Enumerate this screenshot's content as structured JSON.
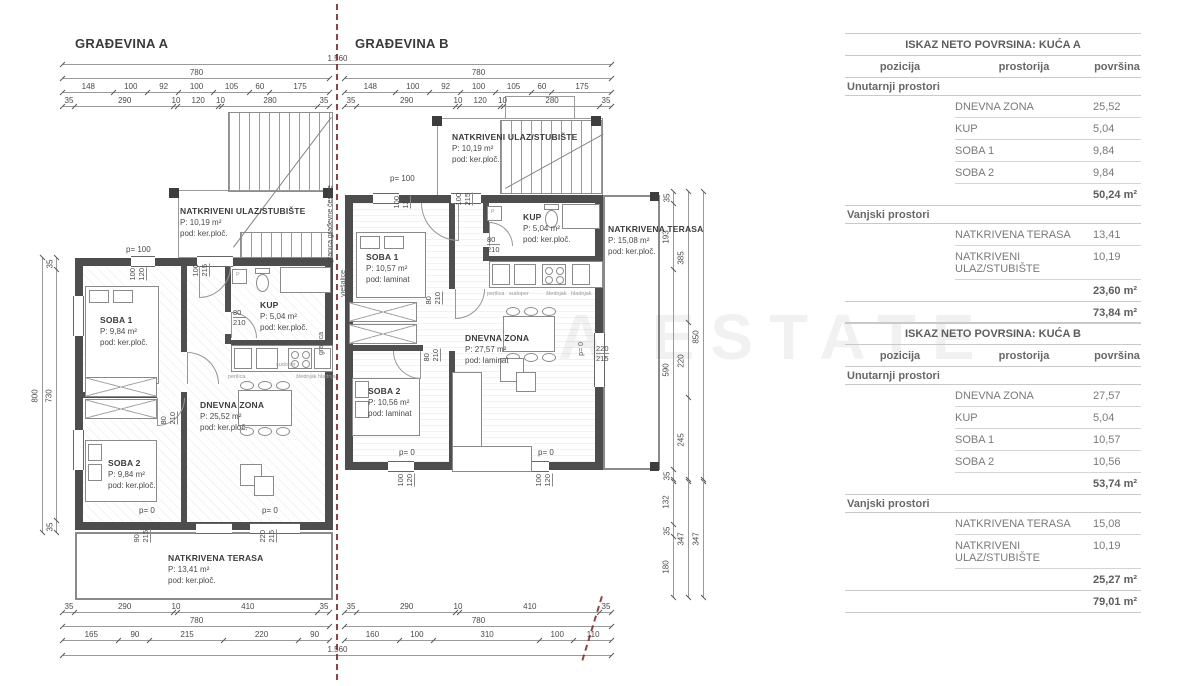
{
  "drawing": {
    "watermark": "A ESTATE",
    "boundary_label": "granica građevne čestice",
    "buildings": [
      {
        "title": "GRAĐEVINA A",
        "rooms": {
          "ulaz": {
            "name": "NATKRIVENI ULAZ/STUBIŠTE",
            "area": "P: 10,19 m²",
            "floor": "pod: ker.ploč."
          },
          "soba1": {
            "name": "SOBA 1",
            "area": "P: 9,84 m²",
            "floor": "pod: ker.ploč."
          },
          "kup": {
            "name": "KUP",
            "area": "P: 5,04 m²",
            "floor": "pod: ker.ploč."
          },
          "dnevna": {
            "name": "DNEVNA ZONA",
            "area": "P: 25,52 m²",
            "floor": "pod: ker.ploč."
          },
          "soba2": {
            "name": "SOBA 2",
            "area": "P: 9,84 m²",
            "floor": "pod: ker.ploč."
          },
          "terasa": {
            "name": "NATKRIVENA TERASA",
            "area": "P: 13,41 m²",
            "floor": "pod: ker.ploč."
          }
        }
      },
      {
        "title": "GRAĐEVINA B",
        "rooms": {
          "ulaz": {
            "name": "NATKRIVENI ULAZ/STUBIŠTE",
            "area": "P: 10,19 m²",
            "floor": "pod: ker.ploč."
          },
          "soba1": {
            "name": "SOBA 1",
            "area": "P: 10,57 m²",
            "floor": "pod: laminat"
          },
          "kup": {
            "name": "KUP",
            "area": "P: 5,04 m²",
            "floor": "pod: ker.ploč."
          },
          "dnevna": {
            "name": "DNEVNA ZONA",
            "area": "P: 27,57 m²",
            "floor": "pod: laminat"
          },
          "soba2": {
            "name": "SOBA 2",
            "area": "P: 10,56 m²",
            "floor": "pod: laminat"
          },
          "terasa": {
            "name": "NATKRIVENA TERASA",
            "area": "P: 15,08 m²",
            "floor": "pod: ker.ploč."
          }
        }
      }
    ],
    "chains": {
      "total_top": [
        "1.560"
      ],
      "w780": [
        "780"
      ],
      "a_top_seg": [
        "148",
        "100",
        "92",
        "100",
        "105",
        "60",
        "175"
      ],
      "a_top_wall": [
        "35",
        "290",
        "10",
        "120",
        "10",
        "280",
        "35"
      ],
      "a_bot_wall": [
        "35",
        "290",
        "10",
        "410",
        "35"
      ],
      "a_bot_seg": [
        "165",
        "90",
        "215",
        "220",
        "90"
      ],
      "b_bot_seg": [
        "160",
        "100",
        "310",
        "100",
        "110"
      ],
      "total_bot": [
        "1.560"
      ],
      "left_inner": [
        "35",
        "730",
        "35"
      ],
      "left_outer": [
        "800"
      ],
      "right_inner_top": [
        "35",
        "193",
        "590",
        "35"
      ],
      "right_inner_bot": [
        "132",
        "35",
        "180"
      ],
      "right_mid_top": [
        "385",
        "220",
        "245"
      ],
      "right_mid_bot": [
        "347"
      ],
      "right_out_top": [
        "850"
      ],
      "right_out_bot": [
        "347"
      ]
    },
    "annotations": [
      {
        "k": "h",
        "x": 126,
        "y": 245,
        "t": "p= 100"
      },
      {
        "k": "vp",
        "x": 128,
        "y": 268,
        "a": "100",
        "b": "120"
      },
      {
        "k": "vp",
        "x": 191,
        "y": 264,
        "a": "100",
        "b": "215"
      },
      {
        "k": "hp",
        "x": 233,
        "y": 308,
        "a": "80",
        "b": "210"
      },
      {
        "k": "vp",
        "x": 159,
        "y": 412,
        "a": "80",
        "b": "210"
      },
      {
        "k": "h",
        "x": 139,
        "y": 506,
        "t": "p= 0"
      },
      {
        "k": "h",
        "x": 262,
        "y": 506,
        "t": "p= 0"
      },
      {
        "k": "vp",
        "x": 132,
        "y": 530,
        "a": "90",
        "b": "215"
      },
      {
        "k": "vp",
        "x": 258,
        "y": 530,
        "a": "220",
        "b": "215"
      },
      {
        "k": "h",
        "x": 390,
        "y": 174,
        "t": "p= 100"
      },
      {
        "k": "vp",
        "x": 392,
        "y": 196,
        "a": "100",
        "b": "120"
      },
      {
        "k": "vp",
        "x": 454,
        "y": 193,
        "a": "100",
        "b": "215"
      },
      {
        "k": "hp",
        "x": 487,
        "y": 235,
        "a": "80",
        "b": "210"
      },
      {
        "k": "vp",
        "x": 424,
        "y": 292,
        "a": "80",
        "b": "210"
      },
      {
        "k": "vp",
        "x": 422,
        "y": 349,
        "a": "80",
        "b": "210"
      },
      {
        "k": "h",
        "x": 399,
        "y": 448,
        "t": "p= 0"
      },
      {
        "k": "h",
        "x": 538,
        "y": 448,
        "t": "p= 0"
      },
      {
        "k": "vp",
        "x": 396,
        "y": 474,
        "a": "100",
        "b": "120"
      },
      {
        "k": "vp",
        "x": 534,
        "y": 474,
        "a": "100",
        "b": "120"
      },
      {
        "k": "hp",
        "x": 596,
        "y": 344,
        "a": "220",
        "b": "215"
      },
      {
        "k": "v",
        "x": 578,
        "y": 342,
        "t": "p= 0"
      },
      {
        "k": "v",
        "x": 340,
        "y": 270,
        "t": "vješalice"
      },
      {
        "k": "v",
        "x": 318,
        "y": 332,
        "t": "granica"
      },
      {
        "k": "t",
        "x": 236,
        "y": 272,
        "t": "P"
      },
      {
        "k": "t",
        "x": 491,
        "y": 209,
        "t": "P"
      },
      {
        "k": "t",
        "x": 228,
        "y": 374,
        "t": "perilica"
      },
      {
        "k": "t",
        "x": 276,
        "y": 362,
        "t": "sudoper"
      },
      {
        "k": "t",
        "x": 296,
        "y": 374,
        "t": "štednjak"
      },
      {
        "k": "t",
        "x": 318,
        "y": 374,
        "t": "hladnjak"
      },
      {
        "k": "t",
        "x": 487,
        "y": 291,
        "t": "perilica"
      },
      {
        "k": "t",
        "x": 509,
        "y": 291,
        "t": "sudoper"
      },
      {
        "k": "t",
        "x": 546,
        "y": 291,
        "t": "štednjak"
      },
      {
        "k": "t",
        "x": 571,
        "y": 291,
        "t": "hladnjak"
      }
    ]
  },
  "tables": [
    {
      "title": "ISKAZ NETO POVRSINA: KUĆA A",
      "headers": [
        "pozicija",
        "prostorija",
        "površina"
      ],
      "sections": [
        {
          "label": "Unutarnji prostori",
          "rows": [
            [
              "DNEVNA ZONA",
              "25,52"
            ],
            [
              "KUP",
              "5,04"
            ],
            [
              "SOBA 1",
              "9,84"
            ],
            [
              "SOBA 2",
              "9,84"
            ]
          ],
          "total": "50,24 m²"
        },
        {
          "label": "Vanjski prostori",
          "rows": [
            [
              "NATKRIVENA TERASA",
              "13,41"
            ],
            [
              "NATKRIVENI ULAZ/STUBIŠTE",
              "10,19"
            ]
          ],
          "total": "23,60 m²"
        }
      ],
      "grand_total": "73,84 m²"
    },
    {
      "title": "ISKAZ NETO POVRSINA: KUĆA B",
      "headers": [
        "pozicija",
        "prostorija",
        "površina"
      ],
      "sections": [
        {
          "label": "Unutarnji prostori",
          "rows": [
            [
              "DNEVNA ZONA",
              "27,57"
            ],
            [
              "KUP",
              "5,04"
            ],
            [
              "SOBA 1",
              "10,57"
            ],
            [
              "SOBA 2",
              "10,56"
            ]
          ],
          "total": "53,74 m²"
        },
        {
          "label": "Vanjski prostori",
          "rows": [
            [
              "NATKRIVENA TERASA",
              "15,08"
            ],
            [
              "NATKRIVENI ULAZ/STUBIŠTE",
              "10,19"
            ]
          ],
          "total": "25,27 m²"
        }
      ],
      "grand_total": "79,01 m²"
    }
  ]
}
